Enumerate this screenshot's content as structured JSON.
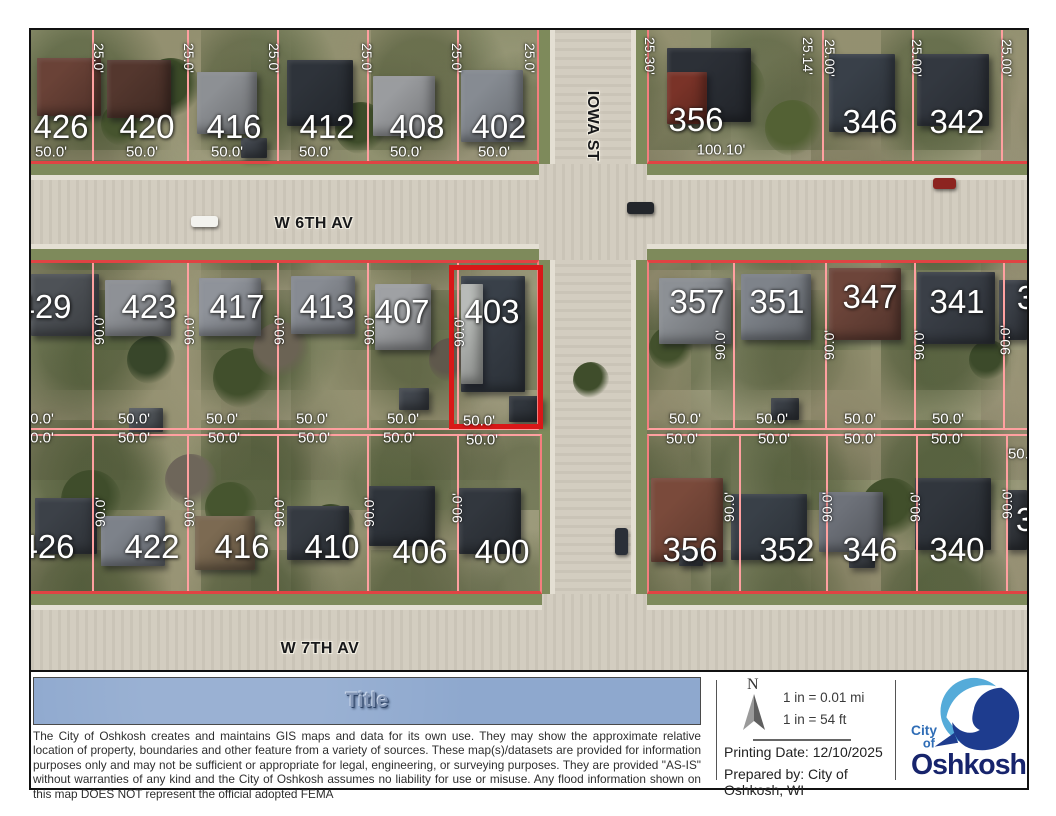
{
  "colors": {
    "parcel_line": "#ffa0a0",
    "parcel_front": "#e04343",
    "parcel_side": "#f47e7e",
    "highlight_red": "#d81818",
    "title_bar_blue": "#8ea8ce",
    "logo_light_blue": "#55abd9",
    "logo_dark_blue": "#1e3c8e",
    "logo_text_navy": "#17246c"
  },
  "map": {
    "highlight": {
      "parcel": "403",
      "x": 418,
      "y": 235,
      "w": 94,
      "h": 164
    },
    "streets": [
      {
        "t": "W 6TH AV",
        "x": 283,
        "y": 194,
        "vert": 0
      },
      {
        "t": "W 7TH AV",
        "x": 289,
        "y": 619,
        "vert": 0
      },
      {
        "t": "IOWA ST",
        "x": 561,
        "y": 96,
        "vert": 1
      }
    ],
    "house_numbers": [
      {
        "t": "426",
        "x": 30,
        "y": 97
      },
      {
        "t": "420",
        "x": 116,
        "y": 97
      },
      {
        "t": "416",
        "x": 203,
        "y": 97
      },
      {
        "t": "412",
        "x": 296,
        "y": 97
      },
      {
        "t": "408",
        "x": 386,
        "y": 97
      },
      {
        "t": "402",
        "x": 468,
        "y": 97
      },
      {
        "t": "356",
        "x": 665,
        "y": 90
      },
      {
        "t": "346",
        "x": 839,
        "y": 92
      },
      {
        "t": "342",
        "x": 926,
        "y": 92
      },
      {
        "t": "429",
        "x": 13,
        "y": 277
      },
      {
        "t": "423",
        "x": 118,
        "y": 277
      },
      {
        "t": "417",
        "x": 206,
        "y": 277
      },
      {
        "t": "413",
        "x": 296,
        "y": 277
      },
      {
        "t": "407",
        "x": 371,
        "y": 282
      },
      {
        "t": "403",
        "x": 461,
        "y": 282
      },
      {
        "t": "357",
        "x": 666,
        "y": 272
      },
      {
        "t": "351",
        "x": 746,
        "y": 272
      },
      {
        "t": "347",
        "x": 839,
        "y": 267
      },
      {
        "t": "341",
        "x": 926,
        "y": 272
      },
      {
        "t": "3",
        "x": 995,
        "y": 268
      },
      {
        "t": "426",
        "x": 16,
        "y": 517
      },
      {
        "t": "422",
        "x": 121,
        "y": 517
      },
      {
        "t": "416",
        "x": 211,
        "y": 517
      },
      {
        "t": "410",
        "x": 301,
        "y": 517
      },
      {
        "t": "406",
        "x": 389,
        "y": 522
      },
      {
        "t": "400",
        "x": 471,
        "y": 522
      },
      {
        "t": "356",
        "x": 659,
        "y": 520
      },
      {
        "t": "352",
        "x": 756,
        "y": 520
      },
      {
        "t": "346",
        "x": 839,
        "y": 520
      },
      {
        "t": "340",
        "x": 926,
        "y": 520
      },
      {
        "t": "3",
        "x": 994,
        "y": 490
      }
    ],
    "dims_h": [
      {
        "t": "50.0'",
        "x": 20,
        "y": 122
      },
      {
        "t": "50.0'",
        "x": 111,
        "y": 122
      },
      {
        "t": "50.0'",
        "x": 196,
        "y": 122
      },
      {
        "t": "50.0'",
        "x": 284,
        "y": 122
      },
      {
        "t": "50.0'",
        "x": 375,
        "y": 122
      },
      {
        "t": "50.0'",
        "x": 463,
        "y": 122
      },
      {
        "t": "100.10'",
        "x": 690,
        "y": 120
      },
      {
        "t": "0.0'",
        "x": 11,
        "y": 389
      },
      {
        "t": "50.0'",
        "x": 103,
        "y": 389
      },
      {
        "t": "50.0'",
        "x": 191,
        "y": 389
      },
      {
        "t": "50.0'",
        "x": 281,
        "y": 389
      },
      {
        "t": "50.0'",
        "x": 372,
        "y": 389
      },
      {
        "t": "50.0'",
        "x": 448,
        "y": 391
      },
      {
        "t": "50.0'",
        "x": 654,
        "y": 389
      },
      {
        "t": "50.0'",
        "x": 741,
        "y": 389
      },
      {
        "t": "50.0'",
        "x": 829,
        "y": 389
      },
      {
        "t": "50.0'",
        "x": 917,
        "y": 389
      },
      {
        "t": "0.0'",
        "x": 11,
        "y": 408
      },
      {
        "t": "50.0'",
        "x": 103,
        "y": 408
      },
      {
        "t": "50.0'",
        "x": 193,
        "y": 408
      },
      {
        "t": "50.0'",
        "x": 283,
        "y": 408
      },
      {
        "t": "50.0'",
        "x": 368,
        "y": 408
      },
      {
        "t": "50.0'",
        "x": 451,
        "y": 410
      },
      {
        "t": "50.0'",
        "x": 651,
        "y": 409
      },
      {
        "t": "50.0'",
        "x": 743,
        "y": 409
      },
      {
        "t": "50.0'",
        "x": 829,
        "y": 409
      },
      {
        "t": "50.0'",
        "x": 916,
        "y": 409
      },
      {
        "t": "50.0'",
        "x": 993,
        "y": 424
      }
    ],
    "dims_v": [
      {
        "t": "25.0'",
        "x": 68,
        "y": 28,
        "up": 0
      },
      {
        "t": "25.0'",
        "x": 158,
        "y": 28,
        "up": 0
      },
      {
        "t": "25.0'",
        "x": 243,
        "y": 28,
        "up": 0
      },
      {
        "t": "25.0'",
        "x": 336,
        "y": 28,
        "up": 0
      },
      {
        "t": "25.0'",
        "x": 426,
        "y": 28,
        "up": 0
      },
      {
        "t": "25.0'",
        "x": 499,
        "y": 28,
        "up": 0
      },
      {
        "t": "25.30'",
        "x": 619,
        "y": 26,
        "up": 0
      },
      {
        "t": "25.14'",
        "x": 777,
        "y": 26,
        "up": 0
      },
      {
        "t": "25.00'",
        "x": 799,
        "y": 28,
        "up": 0
      },
      {
        "t": "25.00'",
        "x": 886,
        "y": 28,
        "up": 0
      },
      {
        "t": "25.00'",
        "x": 976,
        "y": 28,
        "up": 0
      },
      {
        "t": "90.0'",
        "x": 68,
        "y": 300,
        "up": 1
      },
      {
        "t": "90.0'",
        "x": 158,
        "y": 300,
        "up": 1
      },
      {
        "t": "90.0'",
        "x": 248,
        "y": 300,
        "up": 1
      },
      {
        "t": "90.0'",
        "x": 338,
        "y": 300,
        "up": 1
      },
      {
        "t": "90.0'",
        "x": 428,
        "y": 302,
        "up": 1
      },
      {
        "t": "90.0'",
        "x": 689,
        "y": 315,
        "up": 1
      },
      {
        "t": "90.0'",
        "x": 798,
        "y": 315,
        "up": 1
      },
      {
        "t": "90.0'",
        "x": 888,
        "y": 315,
        "up": 1
      },
      {
        "t": "90.0'",
        "x": 974,
        "y": 310,
        "up": 1
      },
      {
        "t": "90.0'",
        "x": 69,
        "y": 482,
        "up": 1
      },
      {
        "t": "90.0'",
        "x": 158,
        "y": 482,
        "up": 1
      },
      {
        "t": "90.0'",
        "x": 248,
        "y": 482,
        "up": 1
      },
      {
        "t": "90.0'",
        "x": 338,
        "y": 482,
        "up": 1
      },
      {
        "t": "90.0'",
        "x": 426,
        "y": 478,
        "up": 1
      },
      {
        "t": "90.0'",
        "x": 698,
        "y": 477,
        "up": 1
      },
      {
        "t": "90.0'",
        "x": 796,
        "y": 477,
        "up": 1
      },
      {
        "t": "90.0'",
        "x": 884,
        "y": 477,
        "up": 1
      },
      {
        "t": "90.0'",
        "x": 976,
        "y": 474,
        "up": 1
      }
    ],
    "street_bands": [
      {
        "x": 508,
        "y": 0,
        "w": 108,
        "h": 642,
        "v": 1
      },
      {
        "x": 0,
        "y": 134,
        "w": 996,
        "h": 96,
        "v": 0
      },
      {
        "x": 0,
        "y": 564,
        "w": 996,
        "h": 78,
        "v": 0
      }
    ],
    "strips": [
      {
        "x": 0,
        "y": 134,
        "w": 508,
        "h": 17,
        "cls": "strip-n"
      },
      {
        "x": 616,
        "y": 134,
        "w": 380,
        "h": 17,
        "cls": "strip-n"
      },
      {
        "x": 0,
        "y": 213,
        "w": 508,
        "h": 17,
        "cls": "strip-s"
      },
      {
        "x": 616,
        "y": 213,
        "w": 380,
        "h": 17,
        "cls": "strip-s"
      },
      {
        "x": 0,
        "y": 564,
        "w": 511,
        "h": 17,
        "cls": "strip-n"
      },
      {
        "x": 616,
        "y": 564,
        "w": 380,
        "h": 17,
        "cls": "strip-n"
      },
      {
        "x": 508,
        "y": 0,
        "w": 17,
        "h": 134,
        "cls": "strip-w"
      },
      {
        "x": 508,
        "y": 230,
        "w": 17,
        "h": 334,
        "cls": "strip-w"
      },
      {
        "x": 599,
        "y": 0,
        "w": 17,
        "h": 134,
        "cls": "strip-e"
      },
      {
        "x": 599,
        "y": 230,
        "w": 17,
        "h": 334,
        "cls": "strip-e"
      }
    ],
    "blocks": [
      {
        "x": 0,
        "y": 0,
        "w": 508,
        "h": 134,
        "lines": [
          61,
          156,
          246,
          336,
          426
        ],
        "front": "bottom",
        "right": 1
      },
      {
        "x": 616,
        "y": 0,
        "w": 380,
        "h": 134,
        "lines": [
          173,
          263,
          352
        ],
        "front": "bottom",
        "left": 1
      },
      {
        "x": 0,
        "y": 230,
        "w": 508,
        "h": 170,
        "lines": [
          61,
          156,
          246,
          336,
          426
        ],
        "front": "top",
        "right": 1,
        "back": "bottom"
      },
      {
        "x": 0,
        "y": 404,
        "w": 511,
        "h": 160,
        "lines": [
          61,
          156,
          246,
          336,
          426
        ],
        "front": "bottom",
        "right": 1,
        "back": "top"
      },
      {
        "x": 616,
        "y": 230,
        "w": 380,
        "h": 170,
        "lines": [
          84,
          176,
          265,
          354
        ],
        "front": "top",
        "left": 1,
        "back": "bottom"
      },
      {
        "x": 616,
        "y": 404,
        "w": 380,
        "h": 160,
        "lines": [
          90,
          177,
          267,
          357
        ],
        "front": "bottom",
        "left": 1,
        "back": "top"
      }
    ],
    "buildings": [
      {
        "x": 6,
        "y": 28,
        "w": 64,
        "h": 58,
        "c": "#6a4237"
      },
      {
        "x": 76,
        "y": 30,
        "w": 64,
        "h": 58,
        "c": "#54372e"
      },
      {
        "x": 166,
        "y": 42,
        "w": 60,
        "h": 62,
        "c": "#8d9094"
      },
      {
        "x": 256,
        "y": 30,
        "w": 66,
        "h": 66,
        "c": "#2e333a"
      },
      {
        "x": 342,
        "y": 46,
        "w": 62,
        "h": 60,
        "c": "#9a9c9f"
      },
      {
        "x": 430,
        "y": 40,
        "w": 62,
        "h": 72,
        "c": "#868b92"
      },
      {
        "x": 636,
        "y": 18,
        "w": 84,
        "h": 74,
        "c": "#2c3037"
      },
      {
        "x": 636,
        "y": 42,
        "w": 40,
        "h": 52,
        "c": "#7a3328"
      },
      {
        "x": 798,
        "y": 24,
        "w": 66,
        "h": 78,
        "c": "#394049"
      },
      {
        "x": 886,
        "y": 24,
        "w": 72,
        "h": 72,
        "c": "#333840"
      },
      {
        "x": 0,
        "y": 244,
        "w": 68,
        "h": 62,
        "c": "#4e5257"
      },
      {
        "x": 74,
        "y": 250,
        "w": 66,
        "h": 56,
        "c": "#8e9196"
      },
      {
        "x": 168,
        "y": 248,
        "w": 62,
        "h": 58,
        "c": "#8f939a"
      },
      {
        "x": 260,
        "y": 246,
        "w": 64,
        "h": 58,
        "c": "#878b92"
      },
      {
        "x": 344,
        "y": 254,
        "w": 56,
        "h": 66,
        "c": "#9fa1a4"
      },
      {
        "x": 430,
        "y": 246,
        "w": 64,
        "h": 116,
        "c": "#394049"
      },
      {
        "x": 430,
        "y": 254,
        "w": 22,
        "h": 100,
        "c": "#b9bcb9"
      },
      {
        "x": 628,
        "y": 248,
        "w": 72,
        "h": 66,
        "c": "#8c9095"
      },
      {
        "x": 710,
        "y": 244,
        "w": 70,
        "h": 66,
        "c": "#7e838a"
      },
      {
        "x": 798,
        "y": 238,
        "w": 72,
        "h": 72,
        "c": "#6d453a"
      },
      {
        "x": 886,
        "y": 242,
        "w": 78,
        "h": 72,
        "c": "#3a3f47"
      },
      {
        "x": 968,
        "y": 250,
        "w": 28,
        "h": 60,
        "c": "#3c4149"
      },
      {
        "x": 4,
        "y": 468,
        "w": 62,
        "h": 56,
        "c": "#3c4148"
      },
      {
        "x": 70,
        "y": 486,
        "w": 64,
        "h": 50,
        "c": "#7d828a"
      },
      {
        "x": 164,
        "y": 486,
        "w": 60,
        "h": 54,
        "c": "#7c6a52"
      },
      {
        "x": 256,
        "y": 476,
        "w": 62,
        "h": 54,
        "c": "#353a41"
      },
      {
        "x": 338,
        "y": 456,
        "w": 66,
        "h": 60,
        "c": "#2f343b"
      },
      {
        "x": 428,
        "y": 458,
        "w": 62,
        "h": 66,
        "c": "#32373e"
      },
      {
        "x": 620,
        "y": 448,
        "w": 72,
        "h": 84,
        "c": "#7a4a3b"
      },
      {
        "x": 700,
        "y": 464,
        "w": 76,
        "h": 66,
        "c": "#394048"
      },
      {
        "x": 788,
        "y": 462,
        "w": 64,
        "h": 60,
        "c": "#6e727a"
      },
      {
        "x": 884,
        "y": 448,
        "w": 76,
        "h": 72,
        "c": "#31363d"
      },
      {
        "x": 975,
        "y": 460,
        "w": 21,
        "h": 60,
        "c": "#35393f"
      },
      {
        "x": 210,
        "y": 108,
        "w": 26,
        "h": 20,
        "c": "#3f444b"
      },
      {
        "x": 368,
        "y": 358,
        "w": 30,
        "h": 22,
        "c": "#42474e"
      },
      {
        "x": 98,
        "y": 378,
        "w": 34,
        "h": 24,
        "c": "#565b60"
      },
      {
        "x": 478,
        "y": 366,
        "w": 34,
        "h": 26,
        "c": "#31363d"
      },
      {
        "x": 740,
        "y": 368,
        "w": 28,
        "h": 22,
        "c": "#3a3f46"
      },
      {
        "x": 818,
        "y": 518,
        "w": 26,
        "h": 20,
        "c": "#43484f"
      },
      {
        "x": 648,
        "y": 518,
        "w": 24,
        "h": 18,
        "c": "#3e434a"
      }
    ],
    "trees": [
      {
        "x": 140,
        "y": 58,
        "r": 30,
        "c": "#3b4a28"
      },
      {
        "x": 92,
        "y": 94,
        "r": 22,
        "c": "#46542e"
      },
      {
        "x": 330,
        "y": 98,
        "r": 26,
        "c": "#3e4c2a"
      },
      {
        "x": 700,
        "y": 58,
        "r": 34,
        "c": "#4a5830"
      },
      {
        "x": 762,
        "y": 98,
        "r": 28,
        "c": "#536134"
      },
      {
        "x": 212,
        "y": 348,
        "r": 30,
        "c": "#414f2c"
      },
      {
        "x": 120,
        "y": 330,
        "r": 24,
        "c": "#38462a"
      },
      {
        "x": 250,
        "y": 320,
        "r": 28,
        "c": "#6b6354"
      },
      {
        "x": 420,
        "y": 330,
        "r": 22,
        "c": "#5f584c"
      },
      {
        "x": 60,
        "y": 470,
        "r": 30,
        "c": "#3f4d2b"
      },
      {
        "x": 200,
        "y": 478,
        "r": 26,
        "c": "#46552f"
      },
      {
        "x": 300,
        "y": 498,
        "r": 24,
        "c": "#3a4828"
      },
      {
        "x": 160,
        "y": 450,
        "r": 26,
        "c": "#6e665a"
      },
      {
        "x": 640,
        "y": 318,
        "r": 22,
        "c": "#42502c"
      },
      {
        "x": 958,
        "y": 330,
        "r": 20,
        "c": "#3c4a2a"
      },
      {
        "x": 860,
        "y": 478,
        "r": 30,
        "c": "#414f2b"
      },
      {
        "x": 560,
        "y": 350,
        "r": 18,
        "c": "#3f4d2b"
      }
    ],
    "cars": [
      {
        "x": 160,
        "y": 186,
        "w": 27,
        "h": 11,
        "c": "#f3f3ef"
      },
      {
        "x": 596,
        "y": 172,
        "w": 27,
        "h": 12,
        "c": "#23262b"
      },
      {
        "x": 902,
        "y": 148,
        "w": 23,
        "h": 11,
        "c": "#8c2420"
      },
      {
        "x": 584,
        "y": 498,
        "w": 13,
        "h": 27,
        "c": "#2a2f38"
      }
    ]
  },
  "footer": {
    "title": "Title",
    "disclaimer": "The City of Oshkosh creates and maintains GIS maps and data for its own use.  They may show the approximate relative location of property, boundaries and other feature from a variety of sources.  These map(s)/datasets are provided for information purposes only and may not be sufficient or appropriate for legal, engineering, or surveying purposes.  They are provided \"AS-IS\" without warranties of any kind and the City of Oshkosh assumes no liability for use or misuse. Any flood information shown on this map DOES NOT represent the official adopted FEMA",
    "north_label": "N",
    "scale_mi": "1 in = 0.01 mi",
    "scale_ft": "1 in = 54 ft",
    "printing_date": "Printing Date: 12/10/2025",
    "prepared_by": "Prepared by: City of Oshkosh, WI",
    "logo": {
      "city": "City",
      "of": "of",
      "name": "Oshkosh"
    }
  }
}
